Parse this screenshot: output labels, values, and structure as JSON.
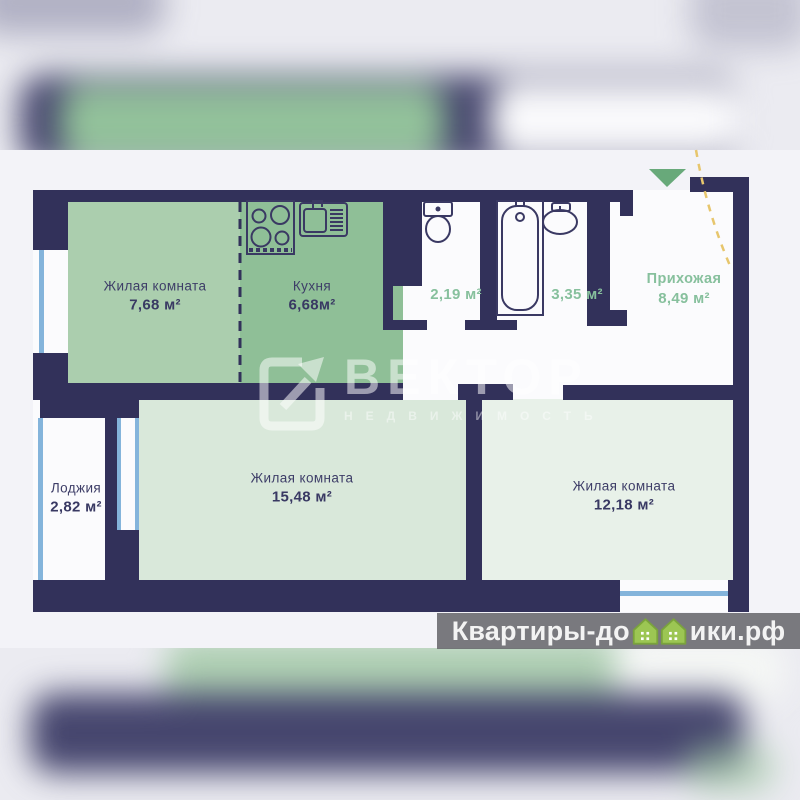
{
  "plan": {
    "rooms": [
      {
        "id": "living-1",
        "name": "Жилая комната",
        "area": "7,68 м²"
      },
      {
        "id": "kitchen",
        "name": "Кухня",
        "area": "6,68м²"
      },
      {
        "id": "wc",
        "name": "",
        "area": "2,19 м²"
      },
      {
        "id": "bathroom",
        "name": "",
        "area": "3,35 м²"
      },
      {
        "id": "hallway",
        "name": "Прихожая",
        "area": "8,49 м²"
      },
      {
        "id": "loggia",
        "name": "Лоджия",
        "area": "2,82 м²"
      },
      {
        "id": "living-2",
        "name": "Жилая комната",
        "area": "15,48 м²"
      },
      {
        "id": "living-3",
        "name": "Жилая комната",
        "area": "12,18 м²"
      }
    ],
    "fixtures": [
      "stove-icon",
      "sink-icon",
      "toilet-icon",
      "bathtub-icon",
      "washbasin-icon"
    ],
    "entrance_marker": "entrance-arrow-icon"
  },
  "watermarks": {
    "center_brand": "ВЕКТОР",
    "center_sub": "НЕДВИЖИМОСТЬ",
    "bottom_left": "Квартиры-до",
    "bottom_right": "ики.рф"
  },
  "colors": {
    "wall": "#32315a",
    "room_living1": "#abceae",
    "room_kitchen": "#8fbf97",
    "room_living2": "#d9e8da",
    "room_living3": "#e8f1e9",
    "label_green": "#87c09d",
    "label_navy": "#3e3e68",
    "window_blue": "#84b4db",
    "entrance_arrow": "#68a97a",
    "door_swing_yellow": "#e7c66d",
    "watermark_house_green": "#9cc653"
  }
}
